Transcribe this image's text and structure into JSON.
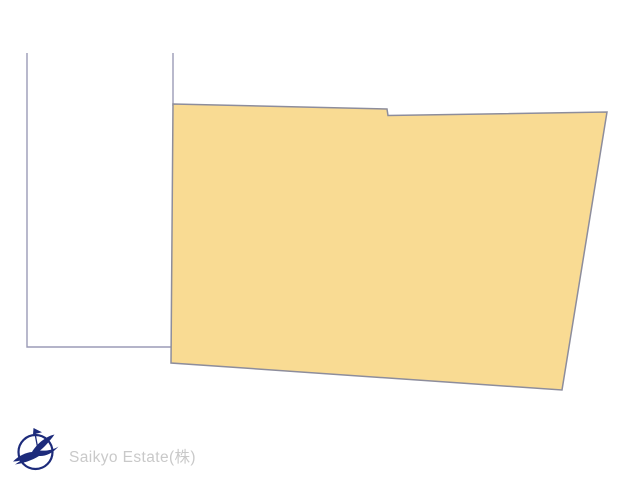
{
  "page": {
    "background": "#ffffff",
    "width": 640,
    "height": 480
  },
  "diagram": {
    "main_parcel": {
      "name": "main land parcel",
      "points": "173,104 387,109 388,115.5 607,112 562,390 171,363",
      "fill": "#F9DB93",
      "stroke": "#8D8D9C",
      "stroke_width": "1.5"
    },
    "adjacent_parcel": {
      "name": "adjacent parcel outline",
      "path": "M 27,53 L 27,347 L 172,347",
      "right_edge_path": "M 173,53 L 173,106",
      "stroke": "#9B9BB7",
      "stroke_width": "1.4"
    }
  },
  "footer": {
    "brand": "Saikyo Estate(株)",
    "brand_color": "#C9C9C9",
    "logo_color": "#1D2B7B"
  }
}
